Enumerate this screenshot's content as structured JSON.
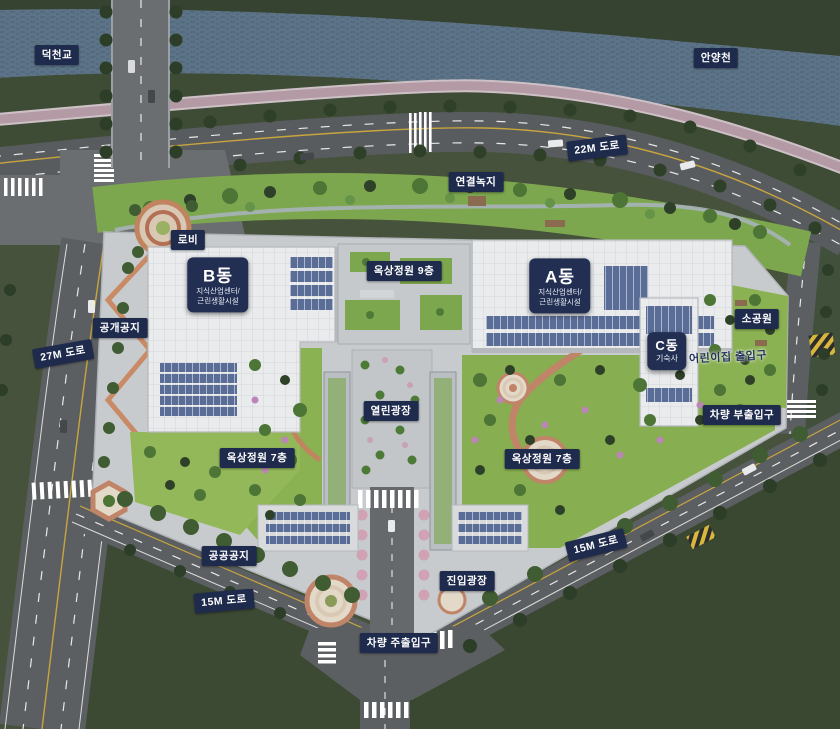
{
  "colors": {
    "label_bg": "#1f2b4d",
    "label_text": "#ffffff",
    "building_label_bg": "#232f52",
    "water": "#5d7488",
    "road": "#5b5e61",
    "grass_dark": "#3a4731",
    "garden_green": "#8ab152",
    "bike_path": "#b39aa4",
    "solar_panel": "#5a6d97",
    "brick_path": "#c0845f"
  },
  "labels": {
    "deokcheon_bridge": "덕천교",
    "anyangcheon": "안양천",
    "road_22m": "22M 도로",
    "connection_green": "연결녹지",
    "lobby": "로비",
    "rooftop_garden_9f": "옥상정원 9층",
    "public_open_space": "공개공지",
    "road_27m": "27M 도로",
    "small_park": "소공원",
    "daycare_entrance": "어린이집 출입구",
    "vehicle_sub_entrance": "차량 부출입구",
    "open_plaza": "열린광장",
    "rooftop_garden_7f_left": "옥상정원 7층",
    "rooftop_garden_7f_right": "옥상정원 7층",
    "public_land": "공공공지",
    "road_15m_left": "15M 도로",
    "road_15m_right": "15M 도로",
    "entry_plaza": "진입광장",
    "vehicle_main_entrance": "차량 주출입구"
  },
  "buildings": {
    "a": {
      "title": "A동",
      "sub1": "지식산업센터/",
      "sub2": "근린생활시설"
    },
    "b": {
      "title": "B동",
      "sub1": "지식산업센터/",
      "sub2": "근린생활시설"
    },
    "c": {
      "title": "C동",
      "sub1": "기숙사"
    }
  }
}
